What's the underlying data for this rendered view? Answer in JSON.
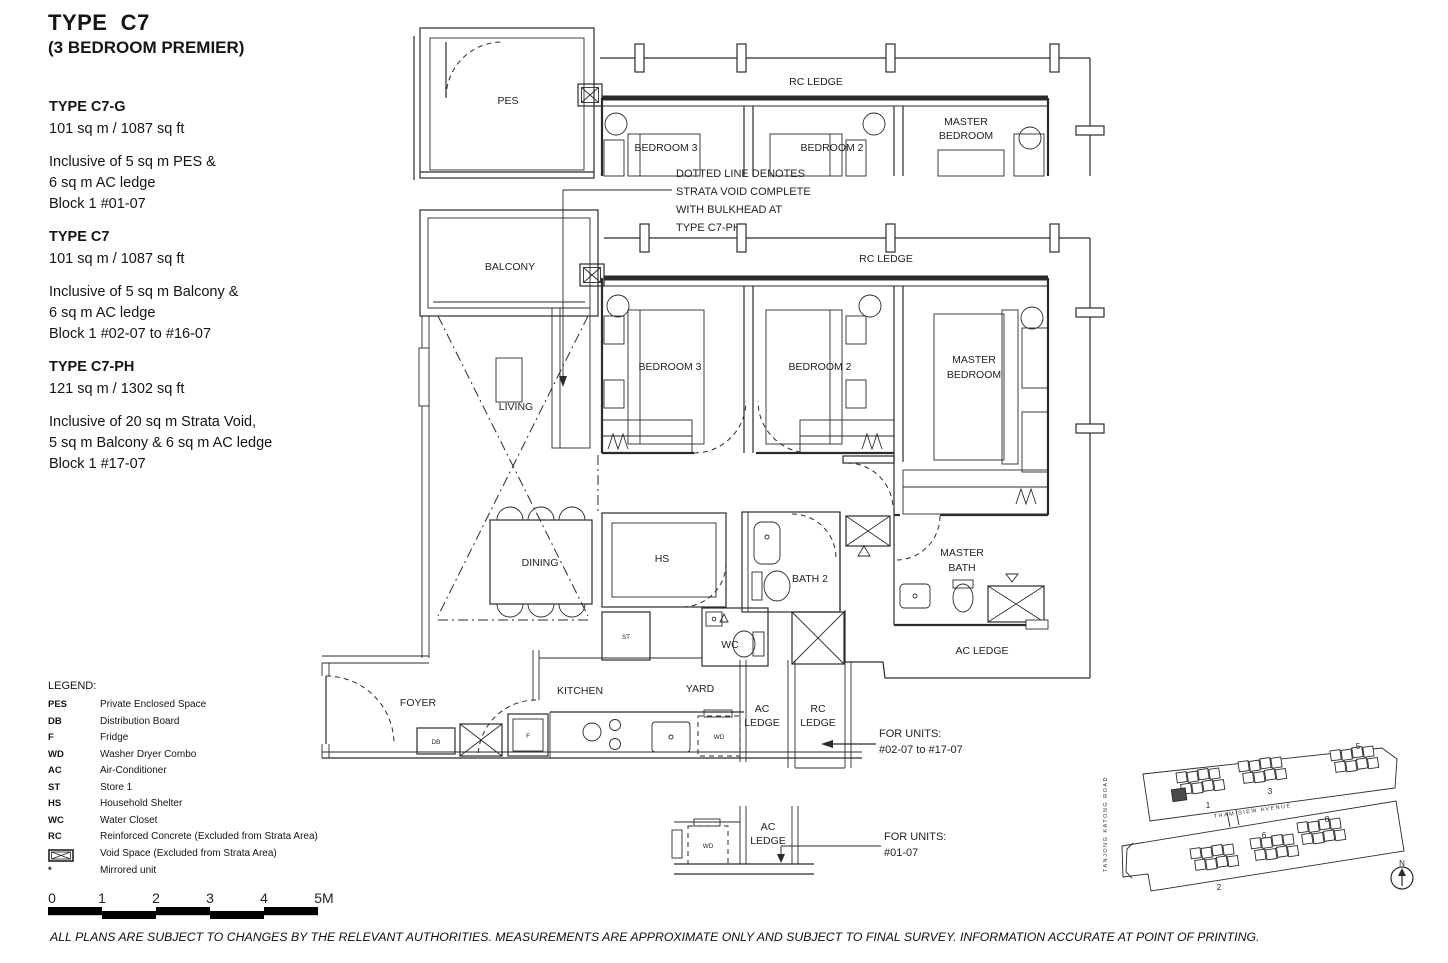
{
  "header": {
    "title": "TYPE  C7",
    "subtitle": "(3 BEDROOM PREMIER)"
  },
  "variants": [
    {
      "name": "TYPE C7-G",
      "area": "101 sq m / 1087 sq ft",
      "lines": [
        "Inclusive of 5 sq m PES &",
        "6 sq m AC ledge",
        "Block 1 #01-07"
      ]
    },
    {
      "name": "TYPE C7",
      "area": "101 sq m / 1087 sq ft",
      "lines": [
        "Inclusive of 5 sq m Balcony &",
        "6 sq m AC ledge",
        "Block 1 #02-07 to #16-07"
      ]
    },
    {
      "name": "TYPE C7-PH",
      "area": "121 sq m / 1302 sq ft",
      "lines": [
        "Inclusive of 20 sq m Strata Void,",
        "5 sq m Balcony & 6 sq m AC ledge",
        "Block 1 #17-07"
      ]
    }
  ],
  "legend": {
    "title": "LEGEND:",
    "items": [
      {
        "abbr": "PES",
        "desc": "Private Enclosed Space"
      },
      {
        "abbr": "DB",
        "desc": "Distribution Board"
      },
      {
        "abbr": "F",
        "desc": "Fridge"
      },
      {
        "abbr": "WD",
        "desc": "Washer Dryer Combo"
      },
      {
        "abbr": "AC",
        "desc": "Air-Conditioner"
      },
      {
        "abbr": "ST",
        "desc": "Store 1"
      },
      {
        "abbr": "HS",
        "desc": "Household Shelter"
      },
      {
        "abbr": "WC",
        "desc": "Water Closet"
      },
      {
        "abbr": "RC",
        "desc": "Reinforced Concrete (Excluded from Strata Area)"
      },
      {
        "abbr": "",
        "desc": "Void Space (Excluded from Strata Area)",
        "symbol": "void-space-icon"
      },
      {
        "abbr": "*",
        "desc": "Mirrored unit"
      }
    ]
  },
  "note": {
    "lines": [
      "DOTTED LINE DENOTES",
      "STRATA VOID COMPLETE",
      "WITH BULKHEAD AT",
      "TYPE C7-PH"
    ]
  },
  "plan": {
    "pes": "PES",
    "rc_ledge": "RC LEDGE",
    "bedroom3": "BEDROOM 3",
    "bedroom2": "BEDROOM 2",
    "master_line1": "MASTER",
    "master_line2": "BEDROOM",
    "balcony": "BALCONY",
    "living": "LIVING",
    "dining": "DINING",
    "hs": "HS",
    "bath2": "BATH 2",
    "master_bath_line1": "MASTER",
    "master_bath_line2": "BATH",
    "ac_ledge": "AC LEDGE",
    "wc": "WC",
    "st": "ST",
    "foyer": "FOYER",
    "kitchen": "KITCHEN",
    "yard": "YARD",
    "ac": "AC",
    "rc": "RC",
    "ledge": "LEDGE",
    "db": "DB",
    "fridge": "F",
    "wd": "WD"
  },
  "unit_callouts": {
    "a": {
      "line1": "FOR UNITS:",
      "line2": "#02-07 to #17-07"
    },
    "b": {
      "line1": "FOR UNITS:",
      "line2": "#01-07"
    }
  },
  "site_plan": {
    "road_vertical": "TANJONG KATONG ROAD",
    "road_horizontal": "THAM   SIEW   AVENUE",
    "blocks": [
      "1",
      "3",
      "5",
      "2",
      "6",
      "8"
    ],
    "north_label": "N"
  },
  "scale_bar": {
    "ticks": [
      "0",
      "1",
      "2",
      "3",
      "4",
      "5M"
    ]
  },
  "disclaimer": "ALL PLANS ARE SUBJECT TO CHANGES BY THE RELEVANT AUTHORITIES. MEASUREMENTS ARE APPROXIMATE ONLY AND SUBJECT TO FINAL SURVEY. INFORMATION ACCURATE AT POINT OF PRINTING."
}
